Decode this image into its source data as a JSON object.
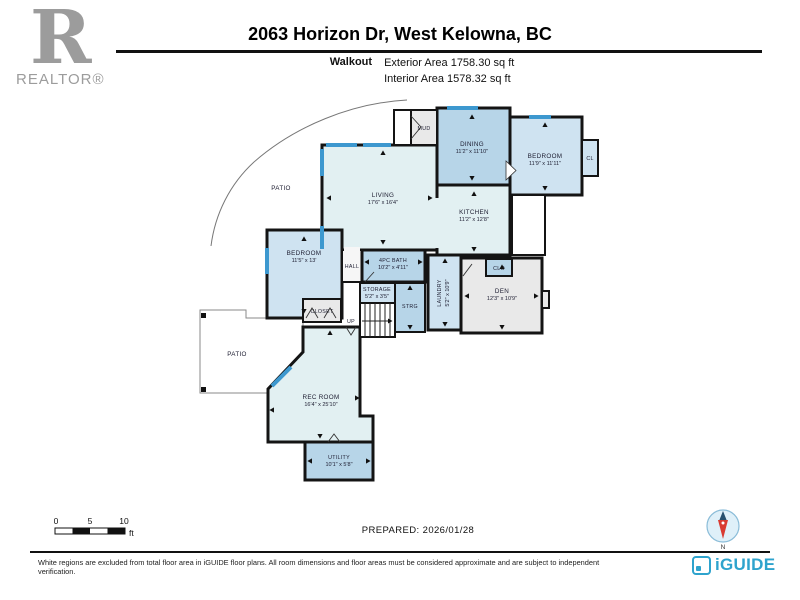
{
  "header": {
    "title": "2063 Horizon Dr, West Kelowna, BC",
    "floor_label": "Walkout",
    "exterior_area": "Exterior Area 1758.30 sq ft",
    "interior_area": "Interior Area 1578.32 sq ft"
  },
  "branding": {
    "realtor_r": "R",
    "realtor": "REALTOR®",
    "iguide": "iGUIDE"
  },
  "plan": {
    "rooms": {
      "mud": {
        "name": "MUD"
      },
      "dining": {
        "name": "DINING",
        "dims": "11'2\" x 11'10\""
      },
      "bedroom2": {
        "name": "BEDROOM",
        "dims": "11'9\" x 11'11\""
      },
      "cl": {
        "name": "CL"
      },
      "living": {
        "name": "LIVING",
        "dims": "17'6\" x 16'4\""
      },
      "patio_upper": {
        "name": "PATIO"
      },
      "kitchen": {
        "name": "KITCHEN",
        "dims": "11'2\" x 12'8\""
      },
      "bedroom1": {
        "name": "BEDROOM",
        "dims": "11'5\" x 13'"
      },
      "hall": {
        "name": "HALL"
      },
      "bath": {
        "name": "4PC BATH",
        "dims": "10'2\" x 4'11\""
      },
      "storage": {
        "name": "STORAGE",
        "dims": "5'2\" x 3'5\""
      },
      "closet": {
        "name": "CLOSET"
      },
      "strg": {
        "name": "STRG"
      },
      "up": {
        "name": "UP"
      },
      "laundry": {
        "name": "LAUNDRY",
        "dims": "5'2\" x 10'9\""
      },
      "clo": {
        "name": "CLO"
      },
      "den": {
        "name": "DEN",
        "dims": "12'3\" x 10'9\""
      },
      "patio_lower": {
        "name": "PATIO"
      },
      "rec_room": {
        "name": "REC ROOM",
        "dims": "16'4\" x 25'10\""
      },
      "utility": {
        "name": "UTILITY",
        "dims": "10'1\" x 5'8\""
      }
    }
  },
  "scale_bar": {
    "start": "0",
    "mid": "5",
    "end": "10",
    "unit": "ft"
  },
  "compass": {
    "north": "N"
  },
  "footer": {
    "prepared": "PREPARED: 2026/01/28",
    "disclaimer": "White regions are excluded from total floor area in iGUIDE floor plans. All room dimensions and floor areas must be considered approximate and are subject to independent verification."
  },
  "colors": {
    "room_pale": "#e2f0f2",
    "room_medium": "#b7d5e8",
    "room_light": "#cfe3f1",
    "room_gray": "#e9e9e9",
    "window_blue": "#3d98cf",
    "wall_black": "#141414",
    "iguide_teal": "#2ea3cd",
    "compass_red": "#d93a31",
    "realtor_gray": "#9c9c9c"
  }
}
